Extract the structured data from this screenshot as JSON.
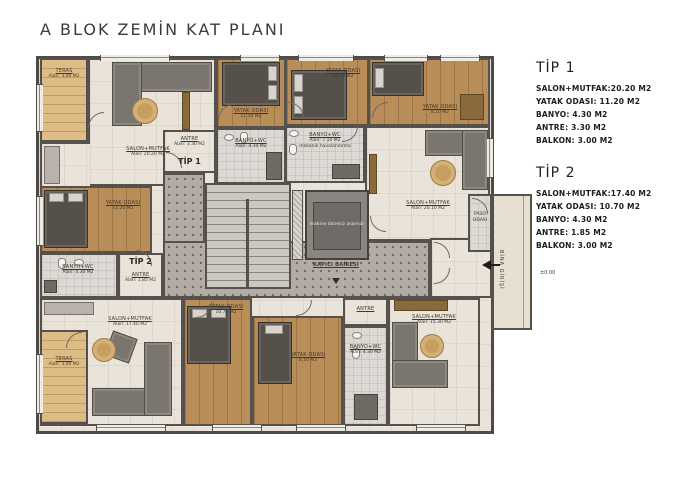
{
  "title": "A BLOK ZEMİN KAT PLANI",
  "legend": {
    "tip1": {
      "heading": "TİP 1",
      "lines": [
        "SALON+MUTFAK:20.20 M2",
        "YATAK ODASI: 11.20 M2",
        "BANYO: 4.30 M2",
        "ANTRE: 3.30 M2",
        "BALKON: 3.00 M2"
      ]
    },
    "tip2": {
      "heading": "TİP 2",
      "lines": [
        "SALON+MUTFAK:17.40 M2",
        "YATAK ODASI: 10.70 M2",
        "BANYO: 4.30 M2",
        "ANTRE: 1.85 M2",
        "BALKON: 3.00 M2"
      ]
    }
  },
  "plan": {
    "type_markers": {
      "tip1": "TİP 1",
      "tip2": "TİP 2"
    },
    "rooms": {
      "teras_tl": {
        "name": "TERAS",
        "area": "Alan: 3.00 M2"
      },
      "salon_tl": {
        "name": "SALON+MUTFAK",
        "area": "Alan: 20.20 M2"
      },
      "antre_tl": {
        "name": "ANTRE",
        "area": "Alan: 3.30 M2"
      },
      "yatak_tl": {
        "name": "YATAK ODASI",
        "area": "11.20 M2"
      },
      "banyo_tl": {
        "name": "BANYO+WC",
        "area": "Alan: 4.30 M2"
      },
      "yatak_top_a": {
        "name": "YATAK ODASI",
        "area": "11.50 M2"
      },
      "yatak_top_b": {
        "name": "YATAK ODASI",
        "area": "12.10 M2"
      },
      "yatak_top_c": {
        "name": "YATAK ODASI",
        "area": "8.10 M2"
      },
      "banyo_tr": {
        "name": "BANYO+WC",
        "area": "Alan: 7.10 M2",
        "note": "mekanik havalandırma"
      },
      "salon_tr": {
        "name": "SALON+MUTFAK",
        "area": "Alan: 20.10 M2"
      },
      "paso": {
        "name": "PASO",
        "area": "ODASI"
      },
      "banyo_bl": {
        "name": "BANYO+WC",
        "area": "Alan: 4.30 M2"
      },
      "antre_bl": {
        "name": "ANTRE",
        "area": "Alan: 1.85 M2"
      },
      "salon_bl": {
        "name": "SALON+MUTFAK",
        "area": "Alan: 17.40 M2"
      },
      "teras_bl": {
        "name": "TERAS",
        "area": "Alan: 3.00 M2"
      },
      "yatak_bl": {
        "name": "YATAK ODASI",
        "area": "10.70 M2"
      },
      "yatak_bm": {
        "name": "YATAK ODASI",
        "area": "8.10 M2"
      },
      "antre_br": {
        "name": "ANTRE"
      },
      "banyo_br": {
        "name": "BANYO+WC",
        "area": "Alan: 4.30 M2"
      },
      "salon_br": {
        "name": "SALON+MUTFAK",
        "area": "Alan: 15.30 M2"
      }
    },
    "core": {
      "elevator": "makine dairesiz asansör",
      "corridor_marker": "KAPICI DAİRESİ"
    },
    "entrance": {
      "label": "BİNA GİRİŞİ",
      "level": "±0.00"
    }
  },
  "colors": {
    "wall": "#56514c",
    "wood": "#b98d58",
    "wood_light": "#ddbd84",
    "tile": "#e9e3d9",
    "corridor": "#b2aca4",
    "rug": "#c59e60"
  }
}
